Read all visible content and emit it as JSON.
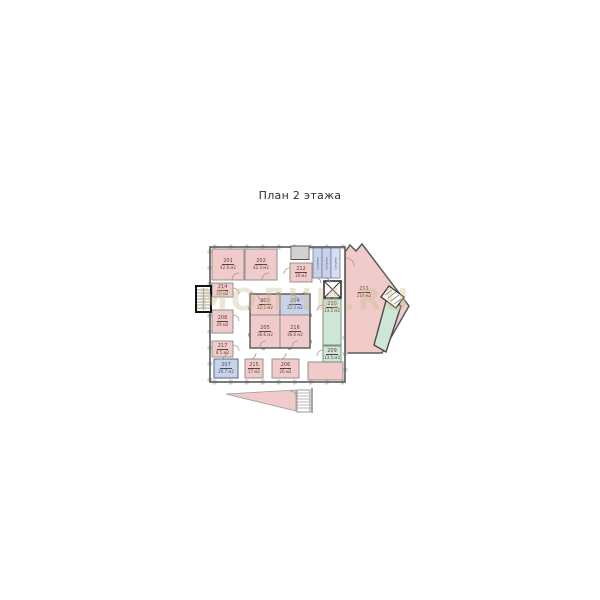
{
  "title": "План 2 этажа",
  "watermark": "МОЛНИ.RU",
  "rooms": [
    {
      "num": "201",
      "area": "42.6 м2"
    },
    {
      "num": "202",
      "area": "42.3 м2"
    },
    {
      "num": "212",
      "area": "10 м2"
    },
    {
      "num": "214",
      "area": "10 м2"
    },
    {
      "num": "208",
      "area": "29 м2"
    },
    {
      "num": "217",
      "area": "8.5 м2"
    },
    {
      "num": "207",
      "area": "20.7 м2"
    },
    {
      "num": "215",
      "area": "17 м2"
    },
    {
      "num": "206",
      "area": "26 м2"
    },
    {
      "num": "203",
      "area": "22.1 м2"
    },
    {
      "num": "204",
      "area": "22.3 м2"
    },
    {
      "num": "205",
      "area": "36.6 м2"
    },
    {
      "num": "216",
      "area": "36.6 м2"
    },
    {
      "num": "210",
      "area": "13.5 м2"
    },
    {
      "num": "209",
      "area": "13.5 м2"
    },
    {
      "num": "211",
      "area": "116 м2"
    }
  ],
  "service_rooms": [
    "Санузел",
    "Санузел",
    "Санузел"
  ],
  "colors": {
    "room_pink": "#f1caca",
    "room_blue": "#c9d3e8",
    "room_green": "#cfe5d5",
    "wall": "#5a5a5a"
  }
}
